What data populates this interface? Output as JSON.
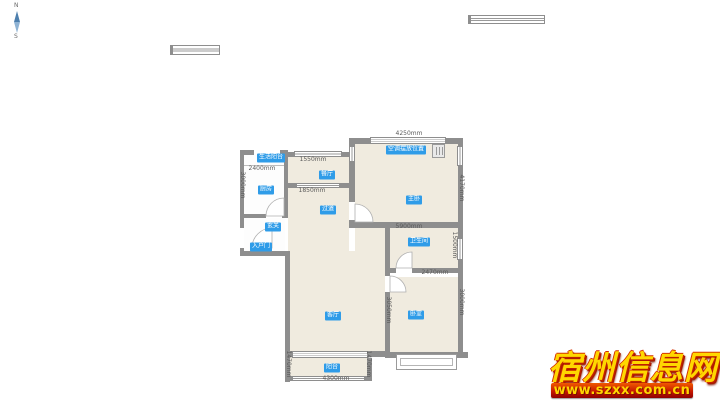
{
  "compass": {
    "north_label": "N",
    "south_label": "S"
  },
  "watermark": {
    "site_name": "宿州信息网",
    "site_url": "www.szxx.com.cn",
    "text_color": "#ffd700",
    "banner_color": "#c81800"
  },
  "plan": {
    "colors": {
      "wall": "#8e8e8e",
      "room_fill": "#f0ebdf",
      "badge": "#2f9ce8"
    },
    "labels": [
      {
        "text": "生活阳台"
      },
      {
        "text": "厨房"
      },
      {
        "text": "餐厅"
      },
      {
        "text": "过道"
      },
      {
        "text": "客厅"
      },
      {
        "text": "主卧"
      },
      {
        "text": "空调摆放位置"
      },
      {
        "text": "卫生间"
      },
      {
        "text": "卧室"
      },
      {
        "text": "阳台"
      },
      {
        "text": "玄关"
      },
      {
        "text": "入户门"
      }
    ],
    "dims": [
      "2400mm",
      "1550mm",
      "1850mm",
      "4250mm",
      "5900mm",
      "2470mm",
      "4300mm",
      "3000mm",
      "4170mm",
      "1500mm",
      "3050mm",
      "3000mm",
      "1470mm",
      "1470mm"
    ]
  }
}
